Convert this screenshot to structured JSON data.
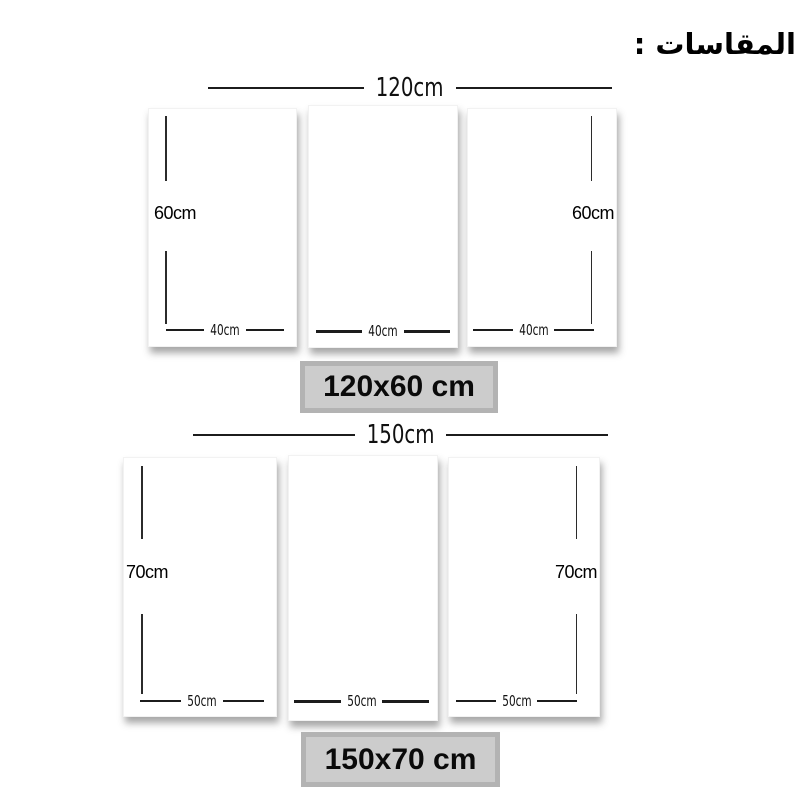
{
  "title": "المقاسات :",
  "sections": [
    {
      "id": "120x60",
      "total_label": "120cm",
      "badge_label": "120x60 cm",
      "panels": [
        {
          "height_label": "60cm",
          "height_side": "left",
          "width_label": "40cm"
        },
        {
          "width_label": "40cm"
        },
        {
          "height_label": "60cm",
          "height_side": "right",
          "width_label": "40cm"
        }
      ]
    },
    {
      "id": "150x70",
      "total_label": "150cm",
      "badge_label": "150x70 cm",
      "panels": [
        {
          "height_label": "70cm",
          "height_side": "left",
          "width_label": "50cm"
        },
        {
          "width_label": "50cm"
        },
        {
          "height_label": "70cm",
          "height_side": "right",
          "width_label": "50cm"
        }
      ]
    }
  ],
  "colors": {
    "background": "#ffffff",
    "panel": "#ffffff",
    "line": "#1c1c1c",
    "text": "#000000",
    "badge_outer": "#b3b3b3",
    "badge_inner": "#cccccc"
  }
}
